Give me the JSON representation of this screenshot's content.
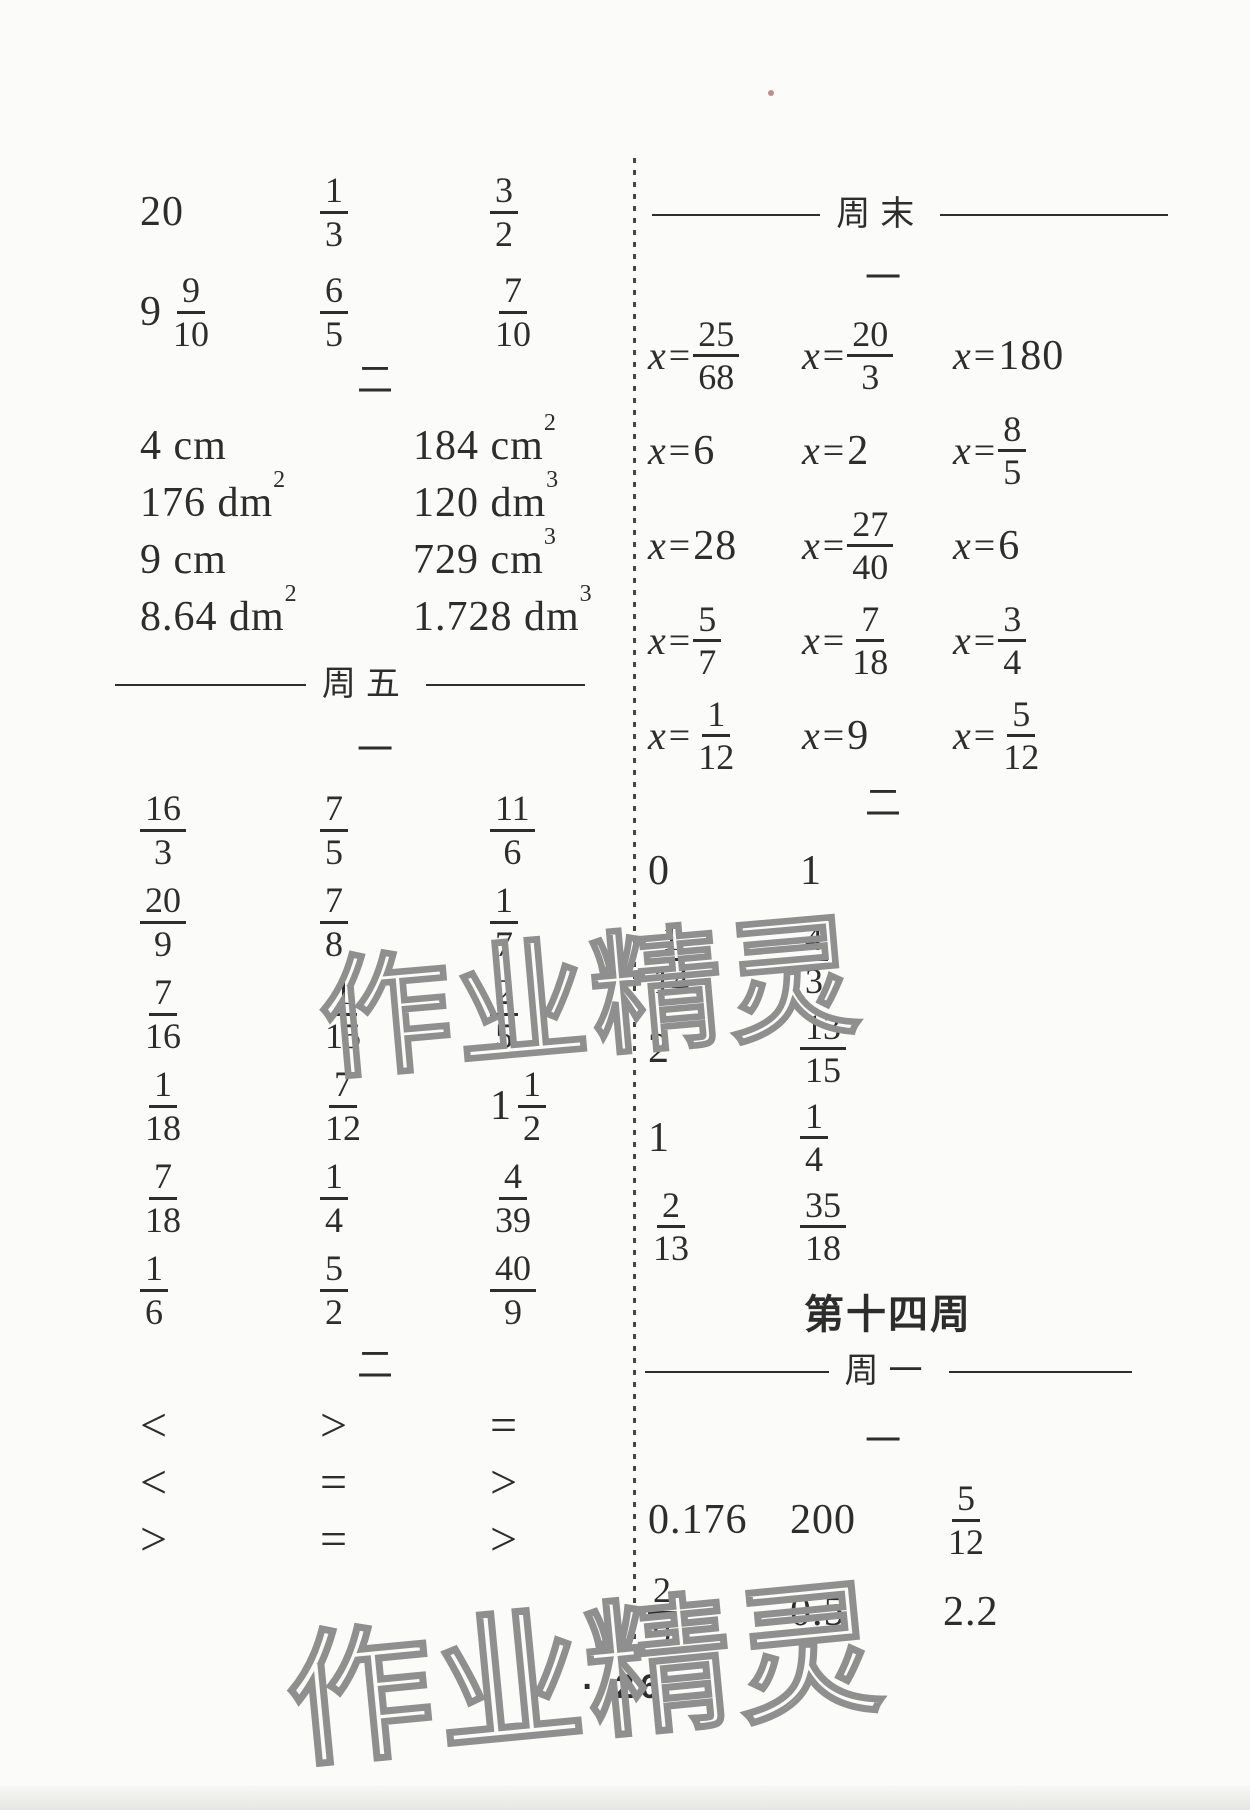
{
  "page_number": "26",
  "page_number_display": "· 26 ·",
  "watermark_text": "作业精灵",
  "left": {
    "section2_label": "二",
    "friday_label": "周五",
    "section1_label": "一",
    "section2b_label": "二",
    "block_a": {
      "rows": [
        [
          {
            "t": "n",
            "v": "20"
          },
          {
            "t": "f",
            "n": "1",
            "d": "3"
          },
          {
            "t": "f",
            "n": "3",
            "d": "2"
          }
        ],
        [
          {
            "t": "m",
            "w": "9",
            "n": "9",
            "d": "10"
          },
          {
            "t": "f",
            "n": "6",
            "d": "5"
          },
          {
            "t": "f",
            "n": "7",
            "d": "10"
          }
        ]
      ]
    },
    "measurements": {
      "rows": [
        [
          {
            "t": "u",
            "v": "4 cm"
          },
          {
            "t": "u",
            "v": "184 cm",
            "sup": "2"
          }
        ],
        [
          {
            "t": "u",
            "v": "176 dm",
            "sup": "2"
          },
          {
            "t": "u",
            "v": "120 dm",
            "sup": "3"
          }
        ],
        [
          {
            "t": "u",
            "v": "9 cm"
          },
          {
            "t": "u",
            "v": "729 cm",
            "sup": "3"
          }
        ],
        [
          {
            "t": "u",
            "v": "8.64 dm",
            "sup": "2"
          },
          {
            "t": "u",
            "v": "1.728 dm",
            "sup": "3"
          }
        ]
      ]
    },
    "fractions": {
      "rows": [
        [
          {
            "t": "f",
            "n": "16",
            "d": "3"
          },
          {
            "t": "f",
            "n": "7",
            "d": "5"
          },
          {
            "t": "f",
            "n": "11",
            "d": "6"
          }
        ],
        [
          {
            "t": "f",
            "n": "20",
            "d": "9"
          },
          {
            "t": "f",
            "n": "7",
            "d": "8"
          },
          {
            "t": "f",
            "n": "1",
            "d": "7"
          }
        ],
        [
          {
            "t": "f",
            "n": "7",
            "d": "16"
          },
          {
            "t": "f",
            "n": "1",
            "d": "15"
          },
          {
            "t": "f",
            "n": "2",
            "d": "5"
          }
        ],
        [
          {
            "t": "f",
            "n": "1",
            "d": "18"
          },
          {
            "t": "f",
            "n": "7",
            "d": "12"
          },
          {
            "t": "m",
            "w": "1",
            "n": "1",
            "d": "2"
          }
        ],
        [
          {
            "t": "f",
            "n": "7",
            "d": "18"
          },
          {
            "t": "f",
            "n": "1",
            "d": "4"
          },
          {
            "t": "f",
            "n": "4",
            "d": "39"
          }
        ],
        [
          {
            "t": "f",
            "n": "1",
            "d": "6"
          },
          {
            "t": "f",
            "n": "5",
            "d": "2"
          },
          {
            "t": "f",
            "n": "40",
            "d": "9"
          }
        ]
      ]
    },
    "comparisons": {
      "rows": [
        [
          {
            "t": "s",
            "v": "<"
          },
          {
            "t": "s",
            "v": ">"
          },
          {
            "t": "s",
            "v": "="
          }
        ],
        [
          {
            "t": "s",
            "v": "<"
          },
          {
            "t": "s",
            "v": "="
          },
          {
            "t": "s",
            "v": ">"
          }
        ],
        [
          {
            "t": "s",
            "v": ">"
          },
          {
            "t": "s",
            "v": "="
          },
          {
            "t": "s",
            "v": ">"
          }
        ]
      ]
    }
  },
  "right": {
    "weekend_label": "周末",
    "section1_label": "一",
    "section2_label": "二",
    "week14_title": "第十四周",
    "monday_label": "周一",
    "monday_section1_label": "一",
    "equations": {
      "rows": [
        [
          {
            "t": "xf",
            "n": "25",
            "d": "68"
          },
          {
            "t": "xf",
            "n": "20",
            "d": "3"
          },
          {
            "t": "x",
            "v": "180"
          }
        ],
        [
          {
            "t": "x",
            "v": "6"
          },
          {
            "t": "x",
            "v": "2"
          },
          {
            "t": "xf",
            "n": "8",
            "d": "5"
          }
        ],
        [
          {
            "t": "x",
            "v": "28"
          },
          {
            "t": "xf",
            "n": "27",
            "d": "40"
          },
          {
            "t": "x",
            "v": "6"
          }
        ],
        [
          {
            "t": "xf",
            "n": "5",
            "d": "7"
          },
          {
            "t": "xf",
            "n": "7",
            "d": "18"
          },
          {
            "t": "xf",
            "n": "3",
            "d": "4"
          }
        ],
        [
          {
            "t": "xf",
            "n": "1",
            "d": "12"
          },
          {
            "t": "x",
            "v": "9"
          },
          {
            "t": "xf",
            "n": "5",
            "d": "12"
          }
        ]
      ]
    },
    "values": {
      "rows": [
        [
          {
            "t": "n",
            "v": "0"
          },
          {
            "t": "n",
            "v": "1"
          }
        ],
        [
          {
            "t": "f",
            "n": "1",
            "d": "14"
          },
          {
            "t": "f",
            "n": "4",
            "d": "3"
          }
        ],
        [
          {
            "t": "n",
            "v": "2"
          },
          {
            "t": "f",
            "n": "13",
            "d": "15"
          }
        ],
        [
          {
            "t": "n",
            "v": "1"
          },
          {
            "t": "f",
            "n": "1",
            "d": "4"
          }
        ],
        [
          {
            "t": "f",
            "n": "2",
            "d": "13"
          },
          {
            "t": "f",
            "n": "35",
            "d": "18"
          }
        ]
      ]
    },
    "monday_values": {
      "rows": [
        [
          {
            "t": "n",
            "v": "0.176"
          },
          {
            "t": "n",
            "v": "200"
          },
          {
            "t": "f",
            "n": "5",
            "d": "12"
          }
        ],
        [
          {
            "t": "f",
            "n": "2",
            "d": "9"
          },
          {
            "t": "n",
            "v": "0.5"
          },
          {
            "t": "n",
            "v": "2.2"
          }
        ]
      ]
    }
  }
}
